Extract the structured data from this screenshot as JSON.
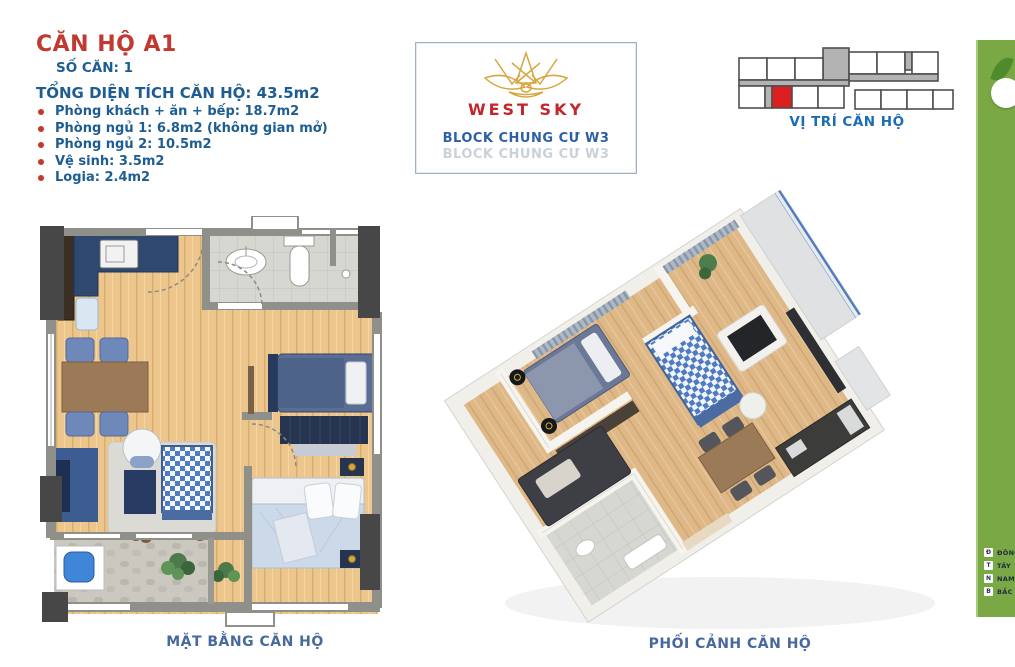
{
  "header": {
    "title": "CĂN HỘ A1",
    "unit_number": "SỐ CĂN: 1",
    "total_area": "TỔNG DIỆN TÍCH CĂN HỘ: 43.5m2",
    "rooms": [
      {
        "label": "Phòng khách + ăn + bếp: 18.7m2"
      },
      {
        "label": "Phòng ngủ 1: 6.8m2 (không gian mở)"
      },
      {
        "label": "Phòng ngủ 2: 10.5m2"
      },
      {
        "label": "Vệ sinh: 3.5m2"
      },
      {
        "label": "Logia: 2.4m2"
      }
    ]
  },
  "logo_card": {
    "brand": "WEST SKY",
    "block_label": "BLOCK CHUNG CƯ W3",
    "block_label_reflection": "BLOCK CHUNG CƯ W3",
    "logo_icon": "lotus-icon"
  },
  "location": {
    "caption": "VỊ TRÍ CĂN HỘ",
    "highlighted_unit": "A1"
  },
  "floor_plan_2d": {
    "caption": "MẶT BẰNG CĂN HỘ"
  },
  "perspective_3d": {
    "caption": "PHỐI CẢNH CĂN HỘ"
  },
  "sidebar": {
    "compass": [
      {
        "abbr": "Đ",
        "label": "ĐÔNG"
      },
      {
        "abbr": "T",
        "label": "TÂY"
      },
      {
        "abbr": "N",
        "label": "NAM"
      },
      {
        "abbr": "B",
        "label": "BẮC"
      }
    ]
  },
  "colors": {
    "title": "#bf3a30",
    "heading": "#1d5d92",
    "bullet": "#c0392b",
    "brand": "#c4262e",
    "gold": "#d6a740",
    "block": "#2d5fa6",
    "blockGhost": "#c9d2da",
    "locLabel": "#1a6cb5",
    "caption": "#48699e",
    "green": "#7aa844",
    "unitRed": "#dd1f1f"
  }
}
